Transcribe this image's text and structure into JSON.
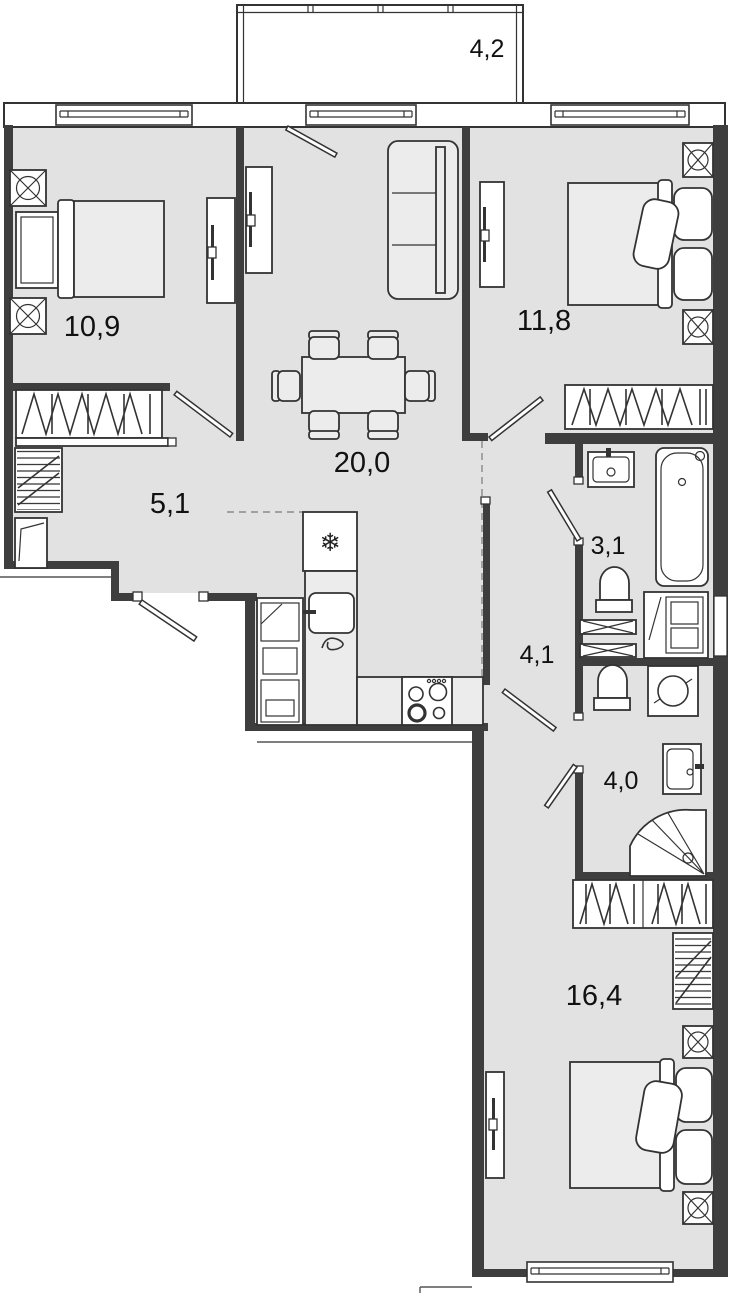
{
  "plan": {
    "type": "apartment-floor-plan",
    "rooms": [
      {
        "id": "balcony",
        "label": "4,2"
      },
      {
        "id": "bedroom-1",
        "label": "10,9"
      },
      {
        "id": "bedroom-2",
        "label": "11,8"
      },
      {
        "id": "living-room-kitchen",
        "label": "20,0"
      },
      {
        "id": "hallway",
        "label": "5,1"
      },
      {
        "id": "bathroom",
        "label": "3,1"
      },
      {
        "id": "corridor",
        "label": "4,1"
      },
      {
        "id": "shower-room",
        "label": "4,0"
      },
      {
        "id": "bedroom-3",
        "label": "16,4"
      }
    ],
    "icons": {
      "fridge": "❄"
    },
    "colors": {
      "background": "#ffffff",
      "floor": "#e2e2e2",
      "wall": "#3e3e3e",
      "line": "#333333",
      "furniture": "#ececec"
    }
  }
}
